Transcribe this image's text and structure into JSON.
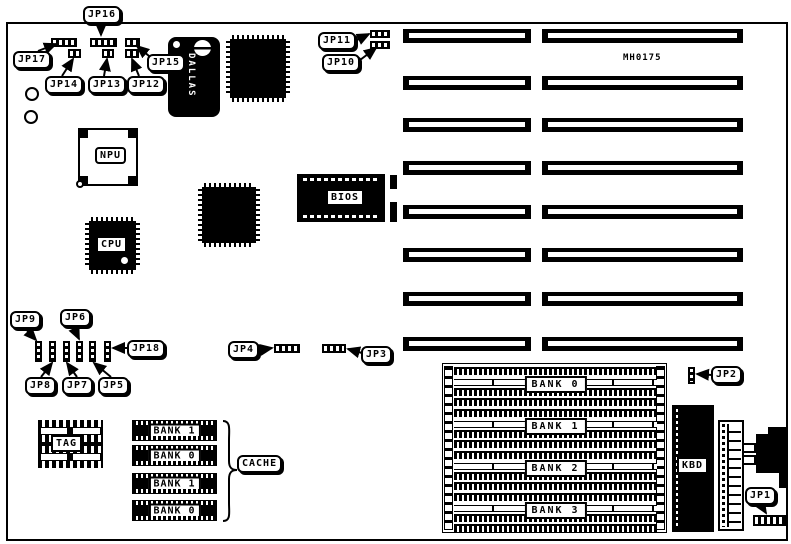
{
  "board": {
    "part_number": "MH0175",
    "rtc_brand": "DALLAS",
    "chips": {
      "npu": "NPU",
      "cpu": "CPU",
      "bios": "BIOS",
      "kbd": "KBD",
      "tag": "TAG",
      "cache": "CACHE"
    },
    "cache_banks": [
      "BANK 1",
      "BANK 0",
      "BANK 1",
      "BANK 0"
    ],
    "memory_banks": [
      "BANK 0",
      "BANK 1",
      "BANK 2",
      "BANK 3"
    ],
    "jumpers": {
      "jp1": "JP1",
      "jp2": "JP2",
      "jp3": "JP3",
      "jp4": "JP4",
      "jp5": "JP5",
      "jp6": "JP6",
      "jp7": "JP7",
      "jp8": "JP8",
      "jp9": "JP9",
      "jp10": "JP10",
      "jp11": "JP11",
      "jp12": "JP12",
      "jp13": "JP13",
      "jp14": "JP14",
      "jp15": "JP15",
      "jp16": "JP16",
      "jp17": "JP17",
      "jp18": "JP18"
    }
  }
}
